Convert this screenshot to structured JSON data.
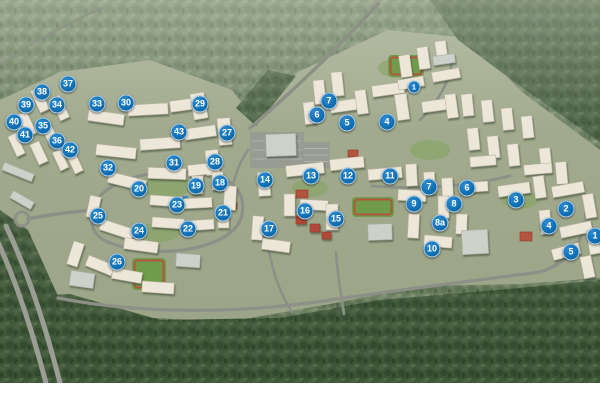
{
  "map": {
    "kind": "aerial-masterplan-render",
    "colors": {
      "marker_blue": "#0e6db1",
      "road": "#8d9087",
      "highway": "#9b9e95",
      "ground": "#9aa385",
      "building_res": "#ece7d9",
      "building_civic": "#ced1c9",
      "building_red": "#b14a38",
      "field_green": "#6f9b4a",
      "track_red": "#b2543e",
      "forest_light": "#66795b",
      "forest_dark": "#37512f"
    },
    "markers": [
      {
        "label": "37",
        "x": 68,
        "y": 84
      },
      {
        "label": "38",
        "x": 42,
        "y": 92
      },
      {
        "label": "39",
        "x": 26,
        "y": 105
      },
      {
        "label": "34",
        "x": 57,
        "y": 105
      },
      {
        "label": "33",
        "x": 97,
        "y": 104
      },
      {
        "label": "30",
        "x": 126,
        "y": 103
      },
      {
        "label": "40",
        "x": 14,
        "y": 122
      },
      {
        "label": "35",
        "x": 43,
        "y": 126
      },
      {
        "label": "41",
        "x": 25,
        "y": 135
      },
      {
        "label": "36",
        "x": 57,
        "y": 141
      },
      {
        "label": "42",
        "x": 70,
        "y": 150
      },
      {
        "label": "32",
        "x": 108,
        "y": 168
      },
      {
        "label": "29",
        "x": 200,
        "y": 104
      },
      {
        "label": "43",
        "x": 179,
        "y": 132
      },
      {
        "label": "27",
        "x": 227,
        "y": 133
      },
      {
        "label": "31",
        "x": 174,
        "y": 163
      },
      {
        "label": "28",
        "x": 215,
        "y": 162
      },
      {
        "label": "20",
        "x": 139,
        "y": 189
      },
      {
        "label": "19",
        "x": 196,
        "y": 186
      },
      {
        "label": "18",
        "x": 220,
        "y": 183
      },
      {
        "label": "25",
        "x": 98,
        "y": 216
      },
      {
        "label": "23",
        "x": 177,
        "y": 205
      },
      {
        "label": "21",
        "x": 223,
        "y": 213
      },
      {
        "label": "24",
        "x": 139,
        "y": 231
      },
      {
        "label": "22",
        "x": 188,
        "y": 229
      },
      {
        "label": "26",
        "x": 117,
        "y": 262
      },
      {
        "label": "14",
        "x": 265,
        "y": 180
      },
      {
        "label": "13",
        "x": 311,
        "y": 176
      },
      {
        "label": "12",
        "x": 348,
        "y": 176
      },
      {
        "label": "16",
        "x": 305,
        "y": 211
      },
      {
        "label": "15",
        "x": 336,
        "y": 219
      },
      {
        "label": "17",
        "x": 269,
        "y": 229
      },
      {
        "label": "11",
        "x": 390,
        "y": 176
      },
      {
        "label": "7",
        "x": 329,
        "y": 101
      },
      {
        "label": "6",
        "x": 317,
        "y": 115
      },
      {
        "label": "5",
        "x": 347,
        "y": 123
      },
      {
        "label": "4",
        "x": 387,
        "y": 122
      },
      {
        "label": "1",
        "x": 414,
        "y": 87,
        "size": 13
      },
      {
        "label": "7",
        "x": 429,
        "y": 187
      },
      {
        "label": "6",
        "x": 467,
        "y": 188
      },
      {
        "label": "9",
        "x": 414,
        "y": 204
      },
      {
        "label": "8",
        "x": 454,
        "y": 204
      },
      {
        "label": "8a",
        "x": 440,
        "y": 223
      },
      {
        "label": "3",
        "x": 516,
        "y": 200
      },
      {
        "label": "2",
        "x": 566,
        "y": 209
      },
      {
        "label": "4",
        "x": 549,
        "y": 226
      },
      {
        "label": "10",
        "x": 432,
        "y": 249
      },
      {
        "label": "1",
        "x": 595,
        "y": 236
      },
      {
        "label": "5",
        "x": 571,
        "y": 252
      }
    ],
    "scene": {
      "clearing": "M0,100 L60,72 L150,60 L232,90 L256,122 L298,72 L388,30 L470,38 L522,92 L600,150 L600,278 L520,284 L420,286 L330,304 L228,322 L118,316 L55,300 L24,240 L0,214 Z",
      "dark_patches": [
        "M430,0 L600,0 L600,142 L520,86 L458,40 Z",
        "M0,298 L70,294 L160,320 L280,318 L380,300 L520,288 L600,280 L600,383 L0,383 Z",
        "M0,210 L28,230 L58,296 L40,310 L0,300 Z",
        "M236,108 L256,126 L296,76 L268,70 Z"
      ],
      "roads": [
        {
          "d": "M6,226 C26,268 44,320 60,383",
          "w": 5,
          "hw": true
        },
        {
          "d": "M-4,238 C16,280 32,330 46,383",
          "w": 5,
          "hw": true
        },
        {
          "d": "M28,219 C52,214 70,212 92,210",
          "w": 3.5
        },
        {
          "d": "M250,128 C292,92 336,50 378,4",
          "w": 3.5
        },
        {
          "d": "M0,64 C30,44 70,22 102,8",
          "w": 2,
          "o": 0.7
        },
        {
          "d": "M92,212 C96,182 150,168 196,172 C232,175 246,192 242,214 C238,242 186,256 140,250 C104,245 88,236 92,212",
          "w": 3.2
        },
        {
          "d": "M58,298 C140,314 240,314 330,300 C420,287 480,280 540,272",
          "w": 3.2
        },
        {
          "d": "M540,272 C572,262 584,240 586,212",
          "w": 3.2
        },
        {
          "d": "M268,246 C274,280 284,300 292,312",
          "w": 2.6
        },
        {
          "d": "M336,252 C338,280 342,300 344,314",
          "w": 2.6
        },
        {
          "d": "M372,186 C420,190 470,186 510,176",
          "w": 2.8
        },
        {
          "d": "M420,120 C440,100 450,80 452,60",
          "w": 2.6
        },
        {
          "d": "M248,150 C240,162 236,172 234,182",
          "w": 2.6
        }
      ],
      "roundabout": {
        "cx": 22,
        "cy": 219,
        "r": 7
      },
      "lawns": [
        [
          165,
          186,
          26,
          12
        ],
        [
          160,
          232,
          20,
          10
        ],
        [
          310,
          188,
          18,
          9
        ],
        [
          430,
          150,
          20,
          10
        ],
        [
          520,
          200,
          18,
          9
        ],
        [
          400,
          68,
          22,
          10
        ]
      ],
      "parks": [
        [
          250,
          132,
          54,
          36
        ],
        [
          302,
          142,
          28,
          26
        ]
      ],
      "fields": [
        [
          132,
          258,
          34,
          32
        ],
        [
          352,
          197,
          42,
          20
        ],
        [
          388,
          55,
          36,
          22
        ]
      ],
      "courts": [
        [
          296,
          190,
          12,
          8
        ],
        [
          520,
          232,
          12,
          9
        ],
        [
          348,
          150,
          10,
          7
        ],
        [
          228,
          203,
          9,
          6
        ]
      ],
      "pool": [
        182,
        196,
        6,
        4
      ],
      "buildings": [
        [
          35,
          88,
          10,
          24,
          -25
        ],
        [
          55,
          96,
          10,
          24,
          -25
        ],
        [
          22,
          112,
          10,
          24,
          -25
        ],
        [
          44,
          120,
          10,
          24,
          -25
        ],
        [
          12,
          134,
          9,
          22,
          -25
        ],
        [
          34,
          142,
          10,
          22,
          -25
        ],
        [
          56,
          150,
          9,
          20,
          -25
        ],
        [
          71,
          155,
          9,
          18,
          -25
        ],
        [
          88,
          112,
          36,
          11,
          8
        ],
        [
          128,
          104,
          40,
          11,
          -3
        ],
        [
          170,
          99,
          34,
          11,
          -8
        ],
        [
          192,
          93,
          14,
          26,
          -10
        ],
        [
          96,
          146,
          40,
          11,
          6
        ],
        [
          140,
          138,
          40,
          11,
          -4
        ],
        [
          184,
          127,
          32,
          11,
          -8
        ],
        [
          218,
          118,
          13,
          27,
          -5
        ],
        [
          206,
          150,
          13,
          25,
          -5
        ],
        [
          108,
          176,
          38,
          11,
          14
        ],
        [
          148,
          168,
          38,
          11,
          2
        ],
        [
          188,
          164,
          26,
          11,
          -6
        ],
        [
          192,
          176,
          11,
          18,
          0
        ],
        [
          212,
          172,
          11,
          18,
          0
        ],
        [
          224,
          186,
          12,
          24,
          3
        ],
        [
          218,
          208,
          11,
          20,
          0
        ],
        [
          150,
          196,
          32,
          10,
          4
        ],
        [
          184,
          198,
          28,
          10,
          -3
        ],
        [
          152,
          218,
          32,
          10,
          4
        ],
        [
          186,
          220,
          28,
          10,
          -4
        ],
        [
          88,
          196,
          11,
          22,
          12
        ],
        [
          100,
          224,
          34,
          11,
          18
        ],
        [
          124,
          240,
          34,
          11,
          8
        ],
        [
          70,
          242,
          11,
          24,
          18
        ],
        [
          86,
          260,
          28,
          11,
          22
        ],
        [
          112,
          270,
          30,
          11,
          10
        ],
        [
          142,
          282,
          32,
          11,
          4
        ],
        [
          258,
          172,
          12,
          24,
          -4
        ],
        [
          286,
          164,
          38,
          11,
          -6
        ],
        [
          330,
          158,
          34,
          11,
          -6
        ],
        [
          284,
          194,
          11,
          22,
          0
        ],
        [
          300,
          200,
          28,
          10,
          3
        ],
        [
          326,
          204,
          12,
          26,
          0
        ],
        [
          252,
          216,
          11,
          24,
          4
        ],
        [
          262,
          240,
          28,
          11,
          8
        ],
        [
          296,
          216,
          10,
          8,
          0,
          "red"
        ],
        [
          310,
          224,
          10,
          8,
          0,
          "red"
        ],
        [
          322,
          232,
          9,
          7,
          0,
          "red"
        ],
        [
          314,
          80,
          11,
          24,
          -6
        ],
        [
          332,
          72,
          11,
          24,
          -6
        ],
        [
          304,
          102,
          11,
          22,
          -6
        ],
        [
          330,
          100,
          32,
          11,
          -8
        ],
        [
          356,
          90,
          11,
          24,
          -8
        ],
        [
          372,
          84,
          32,
          11,
          -8
        ],
        [
          396,
          94,
          12,
          26,
          -8
        ],
        [
          422,
          100,
          28,
          11,
          -8
        ],
        [
          446,
          94,
          11,
          24,
          -8
        ],
        [
          400,
          55,
          11,
          22,
          -8
        ],
        [
          418,
          47,
          11,
          22,
          -8
        ],
        [
          436,
          41,
          11,
          22,
          -8
        ],
        [
          398,
          78,
          26,
          10,
          -10
        ],
        [
          432,
          70,
          28,
          10,
          -10
        ],
        [
          433,
          55,
          22,
          9,
          -8,
          "civic"
        ],
        [
          462,
          94,
          11,
          22,
          -6
        ],
        [
          482,
          100,
          11,
          22,
          -6
        ],
        [
          502,
          108,
          11,
          22,
          -6
        ],
        [
          522,
          116,
          11,
          22,
          -6
        ],
        [
          468,
          128,
          11,
          22,
          -6
        ],
        [
          488,
          136,
          11,
          22,
          -6
        ],
        [
          508,
          144,
          11,
          22,
          -6
        ],
        [
          540,
          148,
          11,
          22,
          -6
        ],
        [
          524,
          164,
          28,
          10,
          -5
        ],
        [
          556,
          162,
          11,
          22,
          -5
        ],
        [
          470,
          156,
          26,
          10,
          -5
        ],
        [
          368,
          168,
          34,
          11,
          -5
        ],
        [
          406,
          164,
          11,
          22,
          -3
        ],
        [
          424,
          172,
          11,
          22,
          -3
        ],
        [
          442,
          178,
          11,
          22,
          -3
        ],
        [
          460,
          182,
          28,
          10,
          -4
        ],
        [
          438,
          196,
          11,
          22,
          0
        ],
        [
          398,
          190,
          28,
          11,
          3
        ],
        [
          408,
          214,
          11,
          24,
          3
        ],
        [
          424,
          236,
          28,
          11,
          5
        ],
        [
          456,
          214,
          11,
          20,
          2
        ],
        [
          462,
          230,
          26,
          24,
          -3,
          "civic"
        ],
        [
          498,
          184,
          32,
          11,
          -8
        ],
        [
          534,
          176,
          11,
          22,
          -8
        ],
        [
          552,
          184,
          32,
          11,
          -10
        ],
        [
          584,
          194,
          11,
          24,
          -10
        ],
        [
          540,
          210,
          11,
          24,
          -6
        ],
        [
          560,
          224,
          32,
          11,
          -12
        ],
        [
          588,
          230,
          11,
          24,
          -10
        ],
        [
          552,
          246,
          28,
          11,
          -15
        ],
        [
          582,
          256,
          11,
          22,
          -12
        ],
        [
          2,
          168,
          32,
          8,
          22,
          "civic"
        ],
        [
          10,
          196,
          24,
          8,
          30,
          "civic"
        ],
        [
          70,
          272,
          24,
          15,
          8,
          "civic"
        ],
        [
          176,
          254,
          24,
          13,
          4,
          "civic"
        ],
        [
          368,
          224,
          24,
          16,
          -2,
          "civic"
        ],
        [
          266,
          134,
          30,
          22,
          -2,
          "civic"
        ]
      ]
    }
  }
}
